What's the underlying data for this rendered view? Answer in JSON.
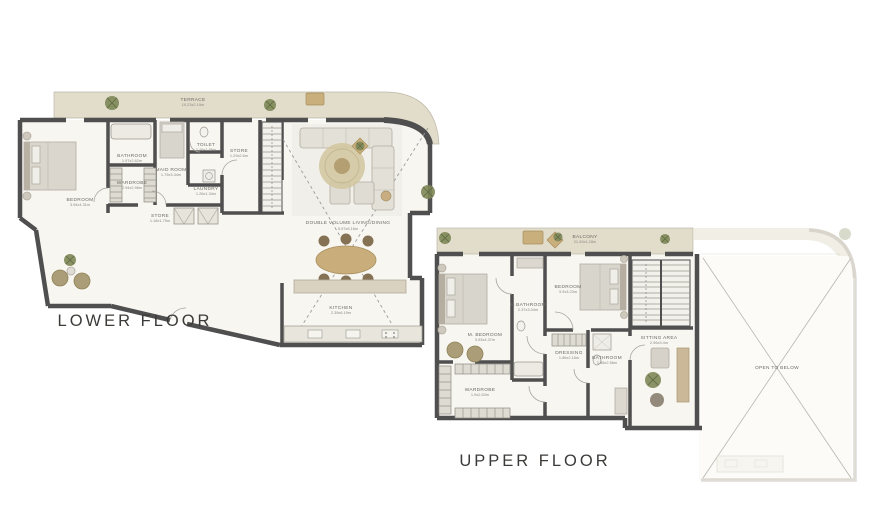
{
  "page": {
    "background": "#ffffff"
  },
  "colors": {
    "wall": "#4f4f4f",
    "floor": "#f8f6f1",
    "terrace": "#e2dccb",
    "wood_tan": "#c9af7c",
    "plant_green": "#7d8757",
    "ghost_wall": "#c9c5ba",
    "label_text": "#6e6a63",
    "title_text": "#3c3b39"
  },
  "floors": [
    {
      "id": "lower-floor",
      "title": "LOWER FLOOR",
      "rooms": [
        {
          "name": "TERRACE",
          "dims": "19.23x2.19m"
        },
        {
          "name": "BEDROOM",
          "dims": "3.94x4.31m"
        },
        {
          "name": "BATHROOM",
          "dims": "1.97x2.62m"
        },
        {
          "name": "WARDROBE",
          "dims": "2.94x2.96m"
        },
        {
          "name": "MAID ROOM",
          "dims": "1.79x3.34m"
        },
        {
          "name": "TOILET",
          "dims": "1.26x1.56m"
        },
        {
          "name": "STORE",
          "dims": "1.29x2.6m"
        },
        {
          "name": "LAUNDRY",
          "dims": "1.26x1.34m"
        },
        {
          "name": "STORE",
          "dims": "1.18x1.75m"
        },
        {
          "name": "DOUBLE VOLUME LIVING/DINING",
          "dims": "5.97x8.16m"
        },
        {
          "name": "KITCHEN",
          "dims": "2.39x6.19m"
        }
      ]
    },
    {
      "id": "upper-floor",
      "title": "UPPER FLOOR",
      "rooms": [
        {
          "name": "BALCONY",
          "dims": "21.39x1.28m"
        },
        {
          "name": "M. BEDROOM",
          "dims": "3.93x4.37m"
        },
        {
          "name": "M.BATHROOM",
          "dims": "2.37x3.04m"
        },
        {
          "name": "BEDROOM",
          "dims": "3.9x3.23m"
        },
        {
          "name": "DRESSING",
          "dims": "1.86x2.16m"
        },
        {
          "name": "BATHROOM",
          "dims": "1.86x2.56m"
        },
        {
          "name": "WARDROBE",
          "dims": "1.9x2.63m"
        },
        {
          "name": "SITTING AREA",
          "dims": "2.96x3.4m"
        },
        {
          "name": "OPEN TO BELOW",
          "dims": ""
        }
      ]
    }
  ]
}
